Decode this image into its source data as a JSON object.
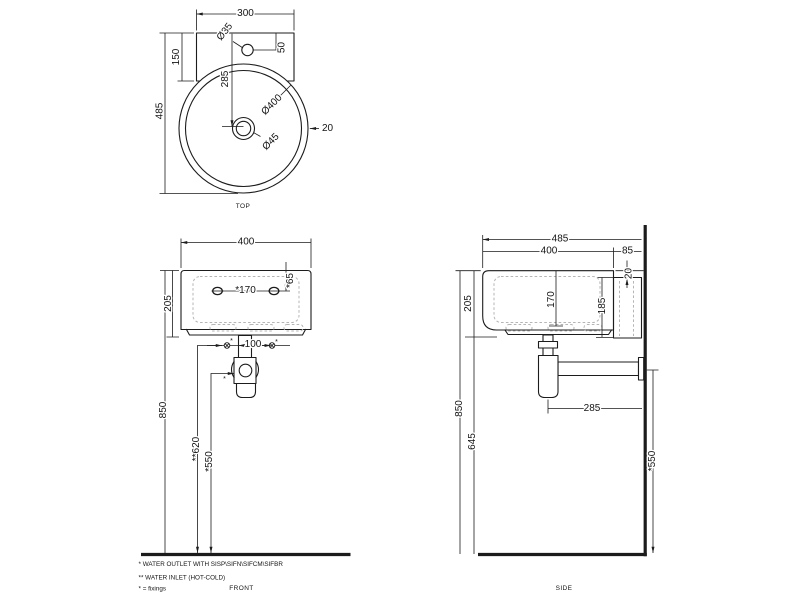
{
  "views": {
    "top": {
      "caption": "TOP",
      "dims": {
        "plate_width": "300",
        "hole_dia": "Ø35",
        "hole_offset": "50",
        "plate_depth": "150",
        "overall_depth": "485",
        "drain_offset": "285",
        "basin_dia": "Ø400",
        "drain_dia": "Ø45",
        "rim_width": "20"
      }
    },
    "front": {
      "caption": "FRONT",
      "dims": {
        "width": "400",
        "height": "205",
        "fixing_spacing": "*170",
        "fixing_drop": "*65",
        "inlet_spacing": "100",
        "rim_height": "850",
        "inlet_height": "**620",
        "outlet_height": "*550",
        "fixing_mark": "*"
      }
    },
    "side": {
      "caption": "SIDE",
      "dims": {
        "overall_depth": "485",
        "basin_depth": "400",
        "wall_gap": "85",
        "rim_drop": "20",
        "height": "205",
        "inner_depth": "170",
        "bracket_height": "185",
        "outlet_to_wall": "285",
        "rim_height": "850",
        "underside_height": "645",
        "outlet_height": "*550"
      }
    }
  },
  "notes": {
    "outlet": "*  WATER OUTLET WITH SISP\\SIFN\\SIFCM\\SIFBR",
    "inlet": "** WATER INLET  (HOT-COLD)",
    "fixings": "* = fixings"
  },
  "colors": {
    "line": "#1c1c1c",
    "hidden": "#b5b5b5",
    "background": "#ffffff"
  }
}
